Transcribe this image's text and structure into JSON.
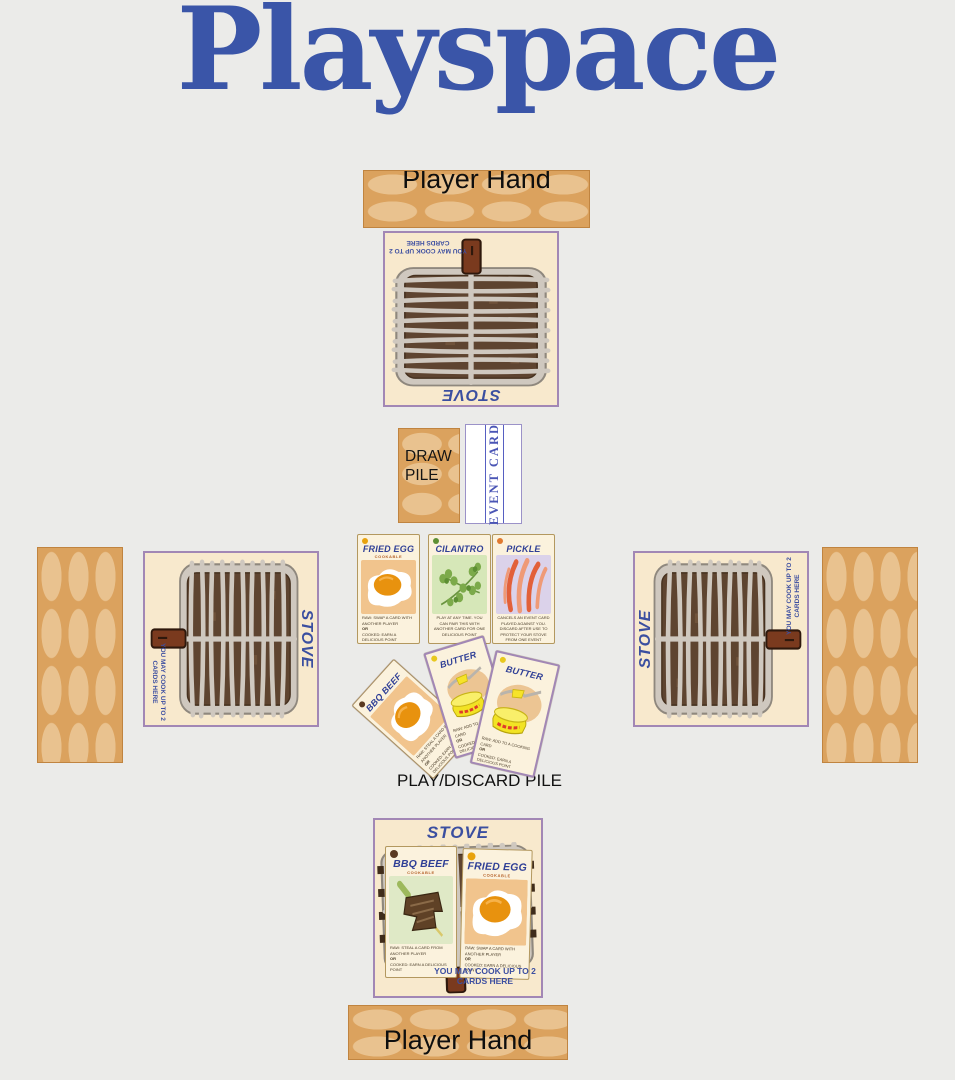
{
  "page": {
    "title": "Playspace"
  },
  "colors": {
    "background": "#ebebe9",
    "title_blue": "#3a55a8",
    "card_navy": "#2f3f96",
    "stove_border_purple": "#a287b5",
    "stove_cream": "#f8e9cd",
    "wood_tan": "#dba25e",
    "event_blue": "#4a55b5"
  },
  "hands": {
    "top": "Player Hand",
    "bottom": "Player Hand"
  },
  "stove": {
    "title": "STOVE",
    "cook_note": "YOU MAY COOK UP TO 2 CARDS HERE"
  },
  "piles": {
    "draw": "DRAW PILE",
    "event": "EVENT CARD",
    "discard": "PLAY/DISCARD PILE"
  },
  "labels": {
    "cookable": "COOKABLE",
    "or": "OR"
  },
  "cards": {
    "fried_egg": {
      "title": "FRIED EGG",
      "raw_rule": "RAW: SWAP A CARD WITH ANOTHER PLAYER",
      "cooked_rule": "COOKED: EARN A DELICIOUS POINT"
    },
    "cilantro": {
      "title": "CILANTRO",
      "rule": "PLAY AT ANY TIME. YOU CAN PAIR THIS WITH ANOTHER CARD FOR ONE DELICIOUS POINT"
    },
    "pickle": {
      "title": "PICKLE",
      "rule": "CANCELS AN EVENT CARD PLAYED AGAINST YOU. DISCARD AFTER USE TO PROTECT YOUR STOVE FROM ONE EVENT"
    },
    "bbq_beef": {
      "title": "BBQ BEEF",
      "raw_rule": "RAW: STEAL A CARD FROM ANOTHER PLAYER",
      "cooked_rule": "COOKED: EARN A DELICIOUS POINT"
    },
    "butter": {
      "title": "BUTTER",
      "raw_rule": "RAW: ADD TO A COOKING CARD",
      "cooked_rule": "COOKED: EARN A DELICIOUS POINT"
    }
  }
}
